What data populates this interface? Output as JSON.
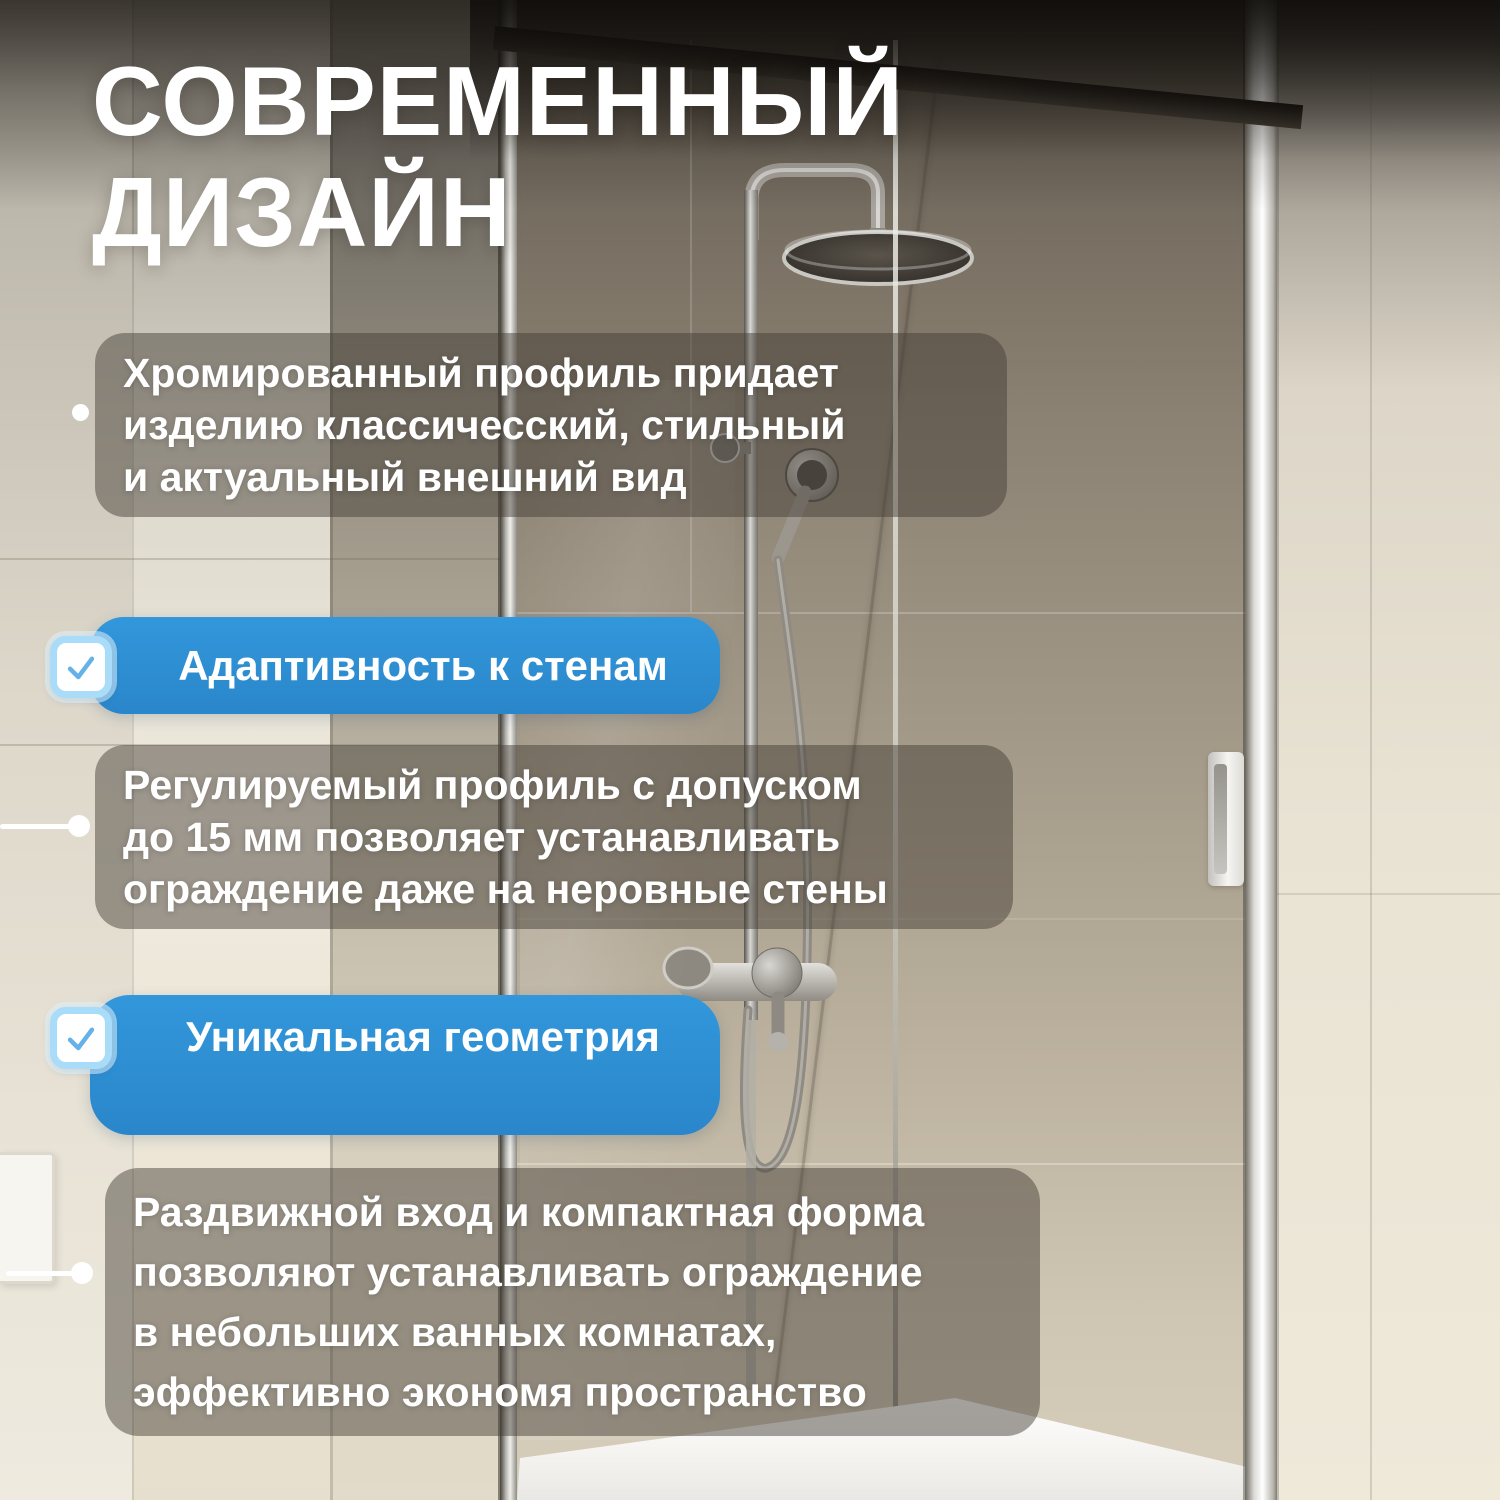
{
  "title": {
    "text": "СОВРЕМЕННЫЙ\nДИЗАЙН"
  },
  "features": {
    "para1": {
      "text": "Хромированный профиль придает\nизделию классичесский, стильный\nи актуальный внешний вид"
    },
    "badge1": {
      "label": "Адаптивность к стенам"
    },
    "para2": {
      "text": "Регулируемый профиль с допуском\nдо 15 мм позволяет устанавливать\nограждение даже на неровные стены"
    },
    "badge2": {
      "label": "Уникальная геометрия"
    },
    "para3": {
      "text": "Раздвижной вход и компактная форма\nпозволяют устанавливать ограждение\nв небольших ванных комнатах,\nэффективно экономя пространство"
    }
  },
  "colors": {
    "accent_blue": "#2E8CD0",
    "checkbox_border": "#A9DCF8",
    "checkmark_blue": "#66B2E8",
    "text_white": "#FFFFFF",
    "panel_overlay": "rgba(66,60,53,0.48)"
  },
  "photo": {
    "scene": "shower enclosure with chrome profile, rain shower column, beige marble tiles, white shower tray"
  }
}
